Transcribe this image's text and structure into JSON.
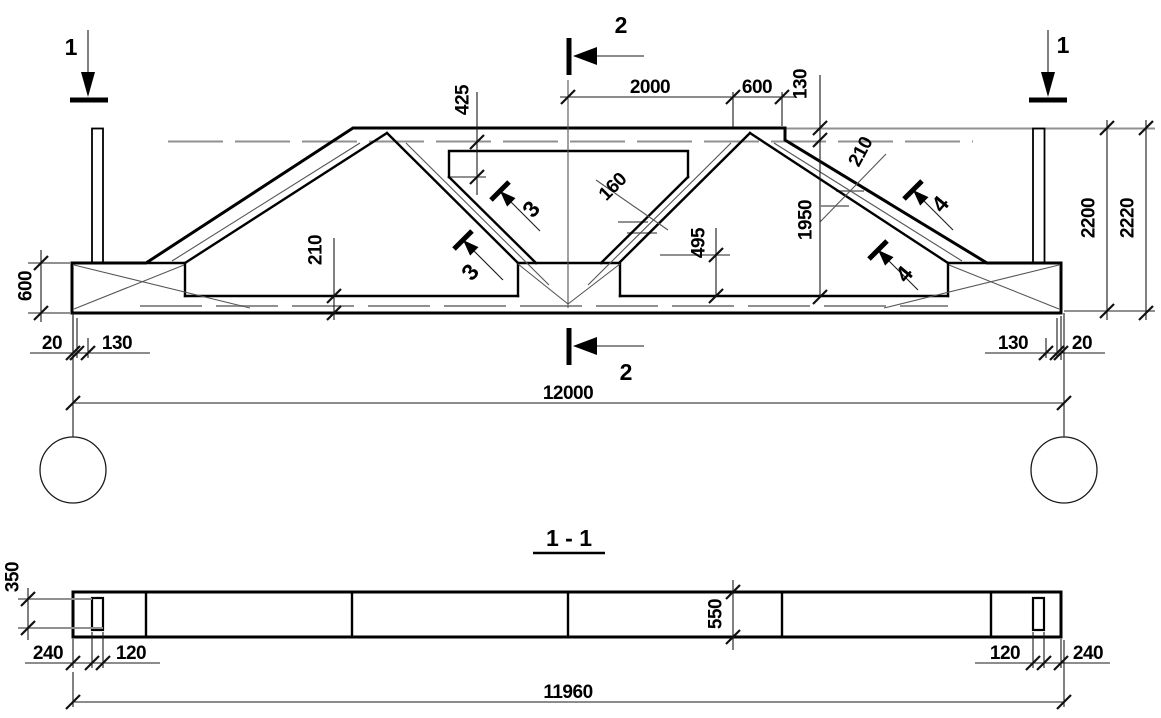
{
  "title": {
    "section": "1 - 1"
  },
  "marks": {
    "cut1": "1",
    "cut2": "2",
    "det3": "3",
    "det4": "4"
  },
  "dims": {
    "top2000": "2000",
    "top600": "600",
    "top130": "130",
    "web425": "425",
    "slot160": "160",
    "chord210_left": "210",
    "chord210_right": "210",
    "v495": "495",
    "v1950": "1950",
    "v2200": "2200",
    "v2220": "2220",
    "left600": "600",
    "bl20": "20",
    "bl130": "130",
    "br130": "130",
    "br20": "20",
    "total12000": "12000",
    "s350": "350",
    "s240l": "240",
    "s120l": "120",
    "s550": "550",
    "s120r": "120",
    "s240r": "240",
    "s11960": "11960"
  },
  "colors": {
    "line": "#000000",
    "thin_line": "#909090",
    "background": "#ffffff"
  }
}
